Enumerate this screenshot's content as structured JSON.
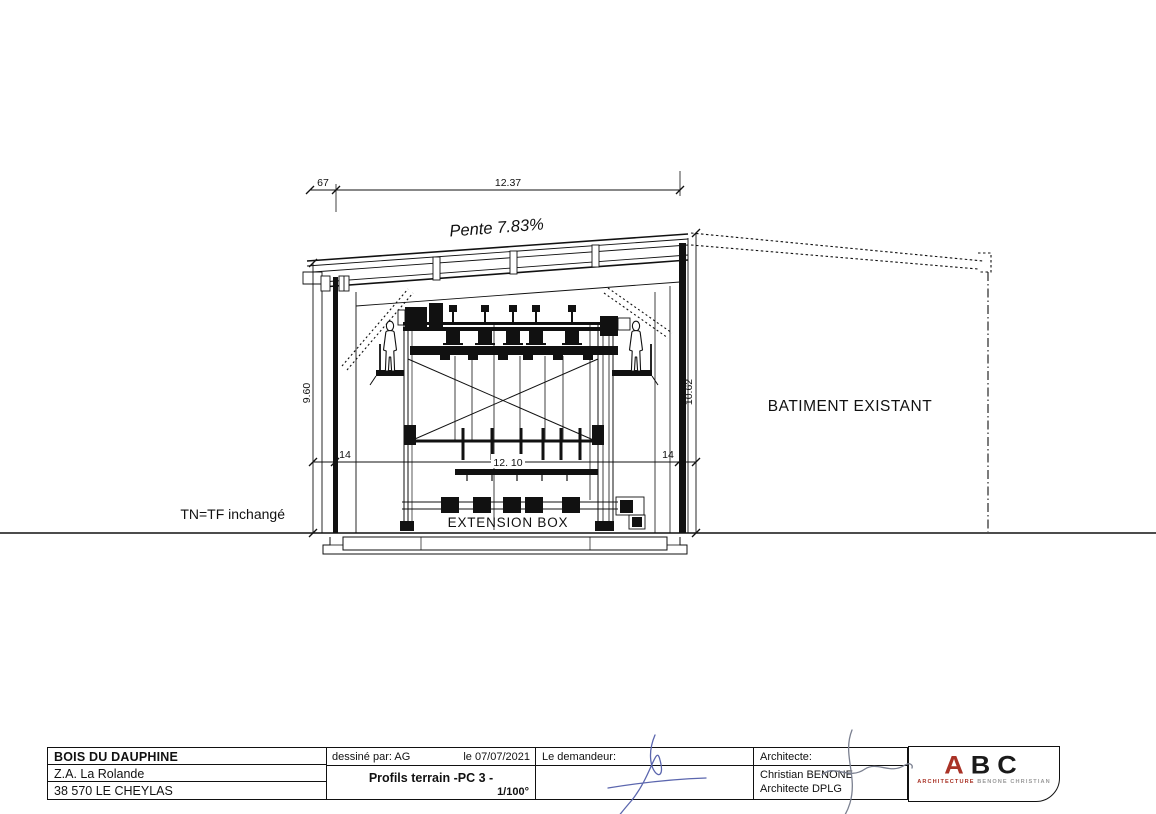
{
  "drawing": {
    "pente_label": "Pente 7.83%",
    "dim_overhang": "67",
    "dim_roof_width": "12.37",
    "dim_left_height": "9.60",
    "dim_right_height": "10.62",
    "dim_wall_left": "14",
    "dim_wall_right": "14",
    "dim_interior_span": "12. 10",
    "extension_box_label": "EXTENSION BOX",
    "existing_building_label": "BATIMENT EXISTANT",
    "ground_label": "TN=TF inchangé"
  },
  "title_block": {
    "company": "BOIS DU DAUPHINE",
    "address_line1": "Z.A. La Rolande",
    "address_line2": "38 570 LE CHEYLAS",
    "drawn_by": "dessiné par: AG",
    "date": "le 07/07/2021",
    "drawing_title": "Profils terrain -PC 3 -",
    "scale": "1/100°",
    "client_label": "Le demandeur:",
    "architect_label": "Architecte:",
    "architect_name": "Christian BENONE",
    "architect_title": "Architecte DPLG"
  },
  "logo": {
    "letter_a": "A",
    "letters_bc": "BC",
    "subtext_left": "ARCHITECTURE",
    "subtext_right": "BENONE CHRISTIAN"
  },
  "colors": {
    "line": "#111111",
    "logo_red": "#a93226",
    "logo_gray": "#9a9a9a",
    "signature_blue": "#5b66ae",
    "signature_gray": "#7b8090"
  }
}
